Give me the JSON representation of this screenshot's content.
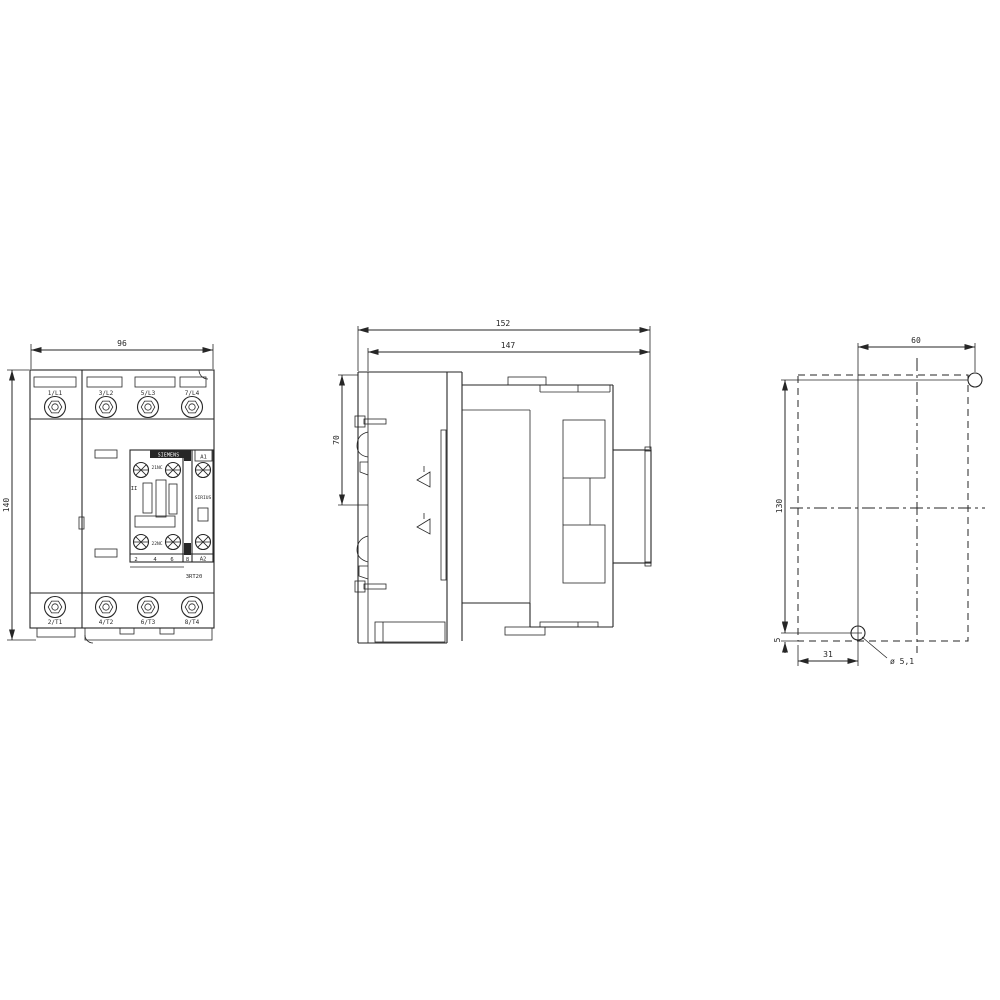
{
  "title": "Contactor dimension drawing",
  "colors": {
    "line": "#262626",
    "background": "#ffffff"
  },
  "front_view": {
    "dim_width": "96",
    "dim_height": "140",
    "terminals_top": [
      "1/L1",
      "3/L2",
      "5/L3",
      "7/L4"
    ],
    "terminals_bottom": [
      "2/T1",
      "4/T2",
      "6/T3",
      "8/T4"
    ],
    "brand": "SIEMENS",
    "aux_label_top": "21NC",
    "aux_label_bottom": "22NC",
    "coil_terminal_top": "A1",
    "coil_terminal_bottom": "A2",
    "series": "SIRIUS",
    "type_label": "3RT20",
    "strip_numbers": [
      "2",
      "4",
      "6",
      "8"
    ],
    "pole_mark": "II"
  },
  "side_view": {
    "dim_depth_overall": "152",
    "dim_depth": "147",
    "dim_clip": "70"
  },
  "mounting_view": {
    "dim_hole_spacing_h": "60",
    "dim_hole_spacing_v": "130",
    "dim_edge_offset": "5",
    "dim_hole_offset_h": "31",
    "hole_callout": "ø 5,1"
  }
}
